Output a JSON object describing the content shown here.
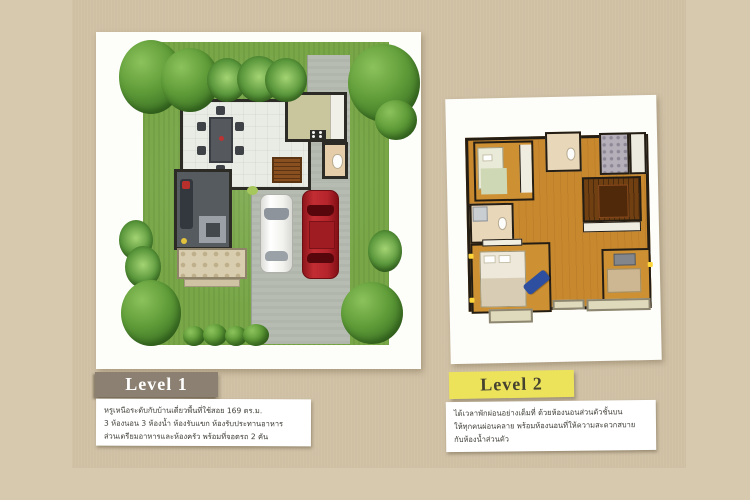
{
  "page": {
    "background_color": "#d7c9ae",
    "panel_color": "#cfc0a4"
  },
  "cards": {
    "level1": {
      "label": "Level 1",
      "label_bg": "#8b8071",
      "label_text_color": "#ffffff",
      "description_lines": [
        "หรูเหนือระดับกับบ้านเดี่ยวพื้นที่ใช้สอย 169 ตร.ม.",
        "3 ห้องนอน 3 ห้องน้ำ ห้องรับแขก ห้องรับประทานอาหาร",
        "ส่วนเตรียมอาหารและห้องครัว พร้อมที่จอดรถ 2 คัน"
      ],
      "plan": {
        "type": "site-plan-ground-floor",
        "features": [
          "lawn",
          "trees",
          "shrubs",
          "driveway",
          "carport",
          "white-car",
          "red-car",
          "dining-room",
          "kitchen",
          "bathroom",
          "stairs",
          "living-room",
          "terrace"
        ],
        "colors": {
          "lawn": "#79a748",
          "driveway": "#b7bcb2",
          "kitchen_floor": "#c9c59d",
          "bath_floor": "#e4cda8",
          "living_floor": "#565b60",
          "terrace": "#d9cdaf",
          "red_car": "#b5242b",
          "white_car": "#f2f2ee"
        }
      }
    },
    "level2": {
      "label": "Level 2",
      "label_bg": "#ece35b",
      "label_text_color": "#45422f",
      "description_lines": [
        "ได้เวลาพักผ่อนอย่างเต็มที่ ด้วยห้องนอนส่วนตัวชั้นบน",
        "ให้ทุกคนผ่อนคลาย พร้อมห้องนอนที่ให้ความสะดวกสบาย",
        "กับห้องน้ำส่วนตัว"
      ],
      "plan": {
        "type": "floor-plan-second-floor",
        "features": [
          "bedroom-1",
          "bathroom-top",
          "tiled-bathroom",
          "stairs",
          "bathroom-left",
          "master-bedroom",
          "blue-daybed",
          "bedroom-2",
          "balconies",
          "wood-flooring"
        ],
        "colors": {
          "wood_floor": "#c8892e",
          "stairs": "#714012",
          "tiled_bath": "#b4afb9",
          "bath_floor": "#e9d7ba",
          "daybed_blue": "#2e4f9f"
        }
      }
    }
  }
}
